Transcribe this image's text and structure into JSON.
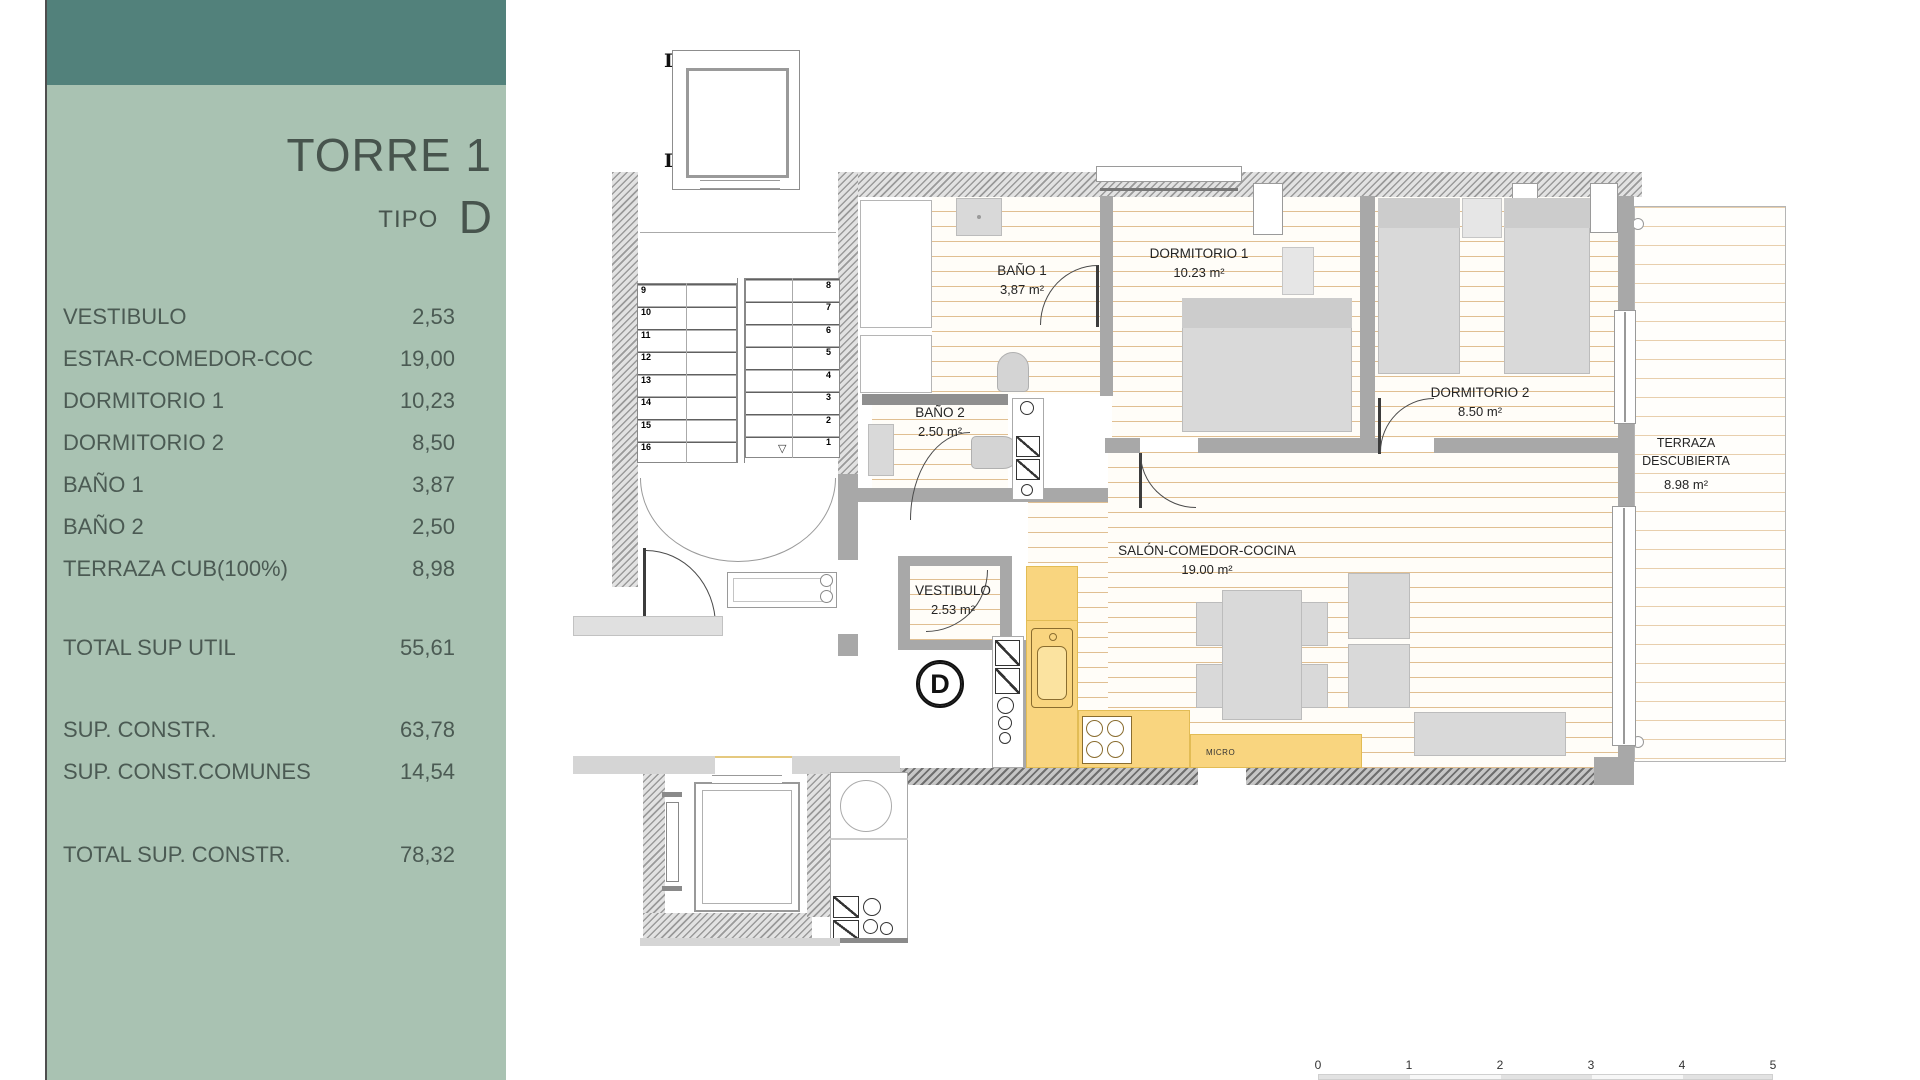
{
  "sidebar": {
    "title": "TORRE 1",
    "tipo_label": "TIPO",
    "tipo_value": "D",
    "rooms": [
      {
        "label": "VESTIBULO",
        "value": "2,53"
      },
      {
        "label": "ESTAR-COMEDOR-COC",
        "value": "19,00"
      },
      {
        "label": "DORMITORIO 1",
        "value": "10,23"
      },
      {
        "label": "DORMITORIO 2",
        "value": "8,50"
      },
      {
        "label": "BAÑO 1",
        "value": "3,87"
      },
      {
        "label": "BAÑO 2",
        "value": "2,50"
      },
      {
        "label": "TERRAZA CUB(100%)",
        "value": "8,98"
      }
    ],
    "total_util": {
      "label": "TOTAL SUP UTIL",
      "value": "55,61"
    },
    "constr": [
      {
        "label": "SUP. CONSTR.",
        "value": "63,78"
      },
      {
        "label": "SUP. CONST.COMUNES",
        "value": "14,54"
      }
    ],
    "total_constr": {
      "label": "TOTAL SUP. CONSTR.",
      "value": "78,32"
    },
    "colors": {
      "header_teal": "#52817b",
      "panel_green": "#a9c2b2",
      "text": "#4b5a53"
    }
  },
  "plan": {
    "marker_letter": "D",
    "micro_label": "MICRO",
    "rooms": {
      "bano1": {
        "name": "BAÑO 1",
        "area": "3,87 m²"
      },
      "dormitorio1": {
        "name": "DORMITORIO 1",
        "area": "10.23 m²"
      },
      "dormitorio2": {
        "name": "DORMITORIO 2",
        "area": "8.50 m²"
      },
      "bano2": {
        "name": "BAÑO 2",
        "area": "2.50 m²"
      },
      "salon": {
        "name": "SALÓN-COMEDOR-COCINA",
        "area": "19.00 m²"
      },
      "vestibulo": {
        "name": "VESTIBULO",
        "area": "2.53 m²"
      },
      "terraza": {
        "name_line1": "TERRAZA",
        "name_line2": "DESCUBIERTA",
        "area": "8.98 m²"
      }
    },
    "stair_left": [
      "9",
      "10",
      "11",
      "12",
      "13",
      "14",
      "15",
      "16"
    ],
    "stair_right": [
      "8",
      "7",
      "6",
      "5",
      "4",
      "3",
      "2",
      "1"
    ],
    "scale_ticks": [
      "0",
      "1",
      "2",
      "3",
      "4",
      "5"
    ],
    "colors": {
      "kitchen_yellow": "#f9d57f",
      "floor_line_tan": "#cb964e",
      "furniture_gray": "#d9d9d9"
    }
  }
}
